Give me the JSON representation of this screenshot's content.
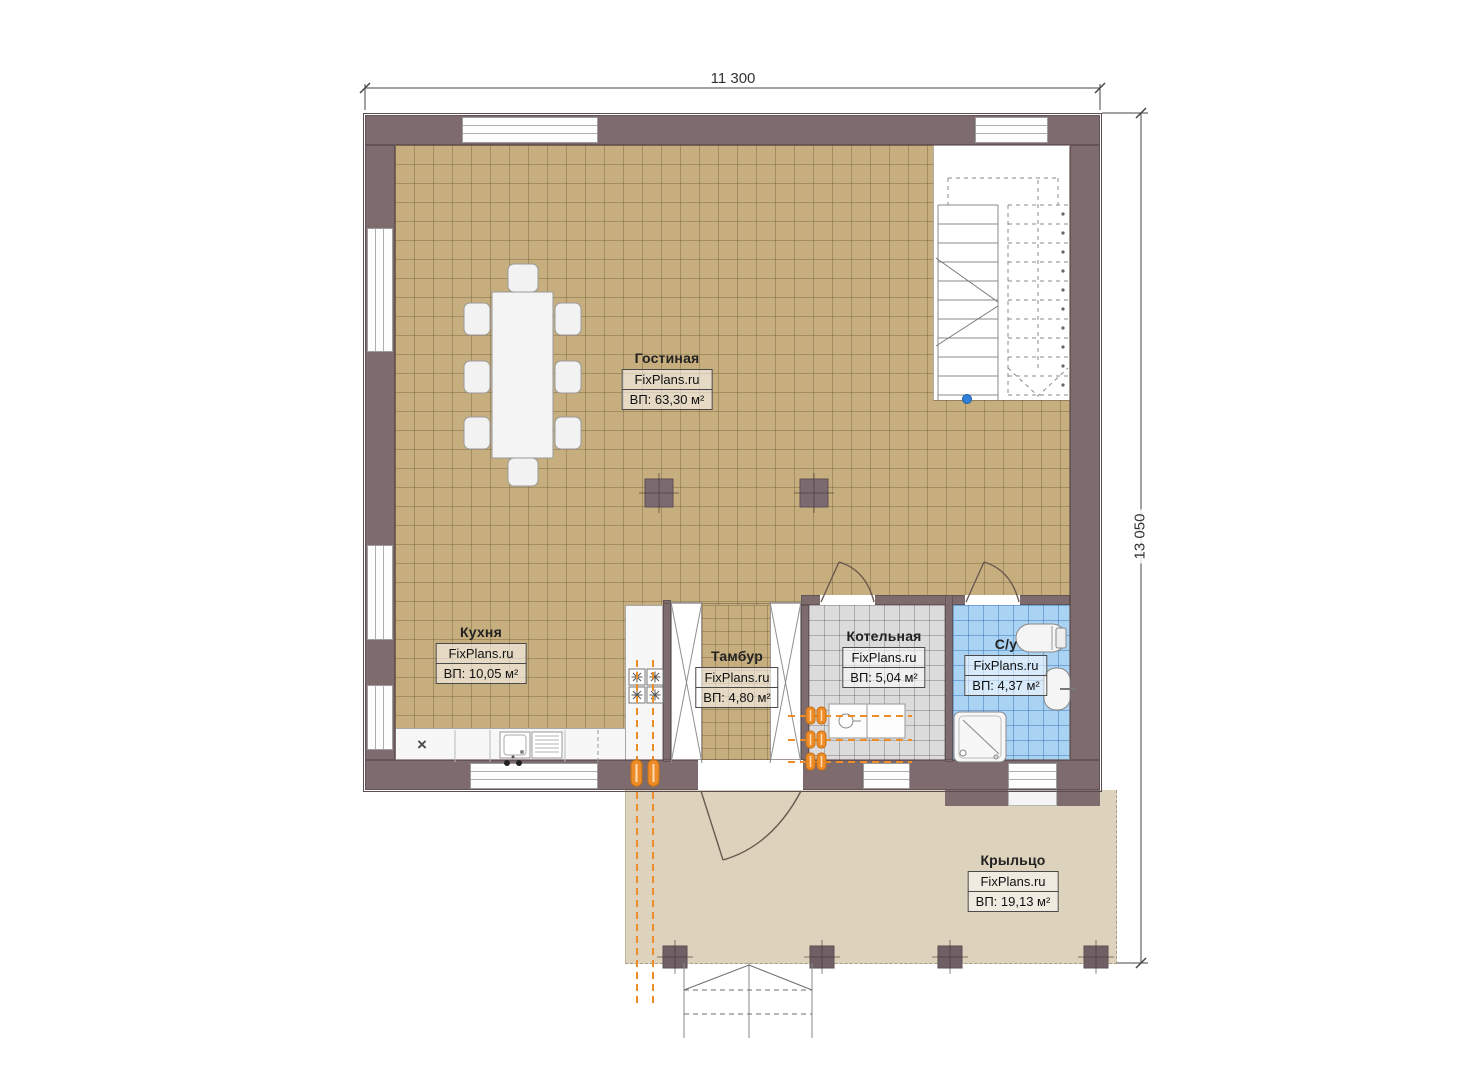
{
  "dimensions": {
    "width_label": "11 300",
    "height_label": "13 050"
  },
  "watermark": "FixPlans.ru",
  "rooms": [
    {
      "name": "Гостиная",
      "area": "ВП: 63,30 м²"
    },
    {
      "name": "Кухня",
      "area": "ВП: 10,05 м²"
    },
    {
      "name": "Тамбур",
      "area": "ВП: 4,80 м²"
    },
    {
      "name": "Котельная",
      "area": "ВП: 5,04 м²"
    },
    {
      "name": "С/у",
      "area": "ВП: 4,37 м²"
    },
    {
      "name": "Крыльцо",
      "area": "ВП: 19,13 м²"
    }
  ],
  "markers": {
    "appliance": "×"
  },
  "colors": {
    "wall": "#7d6b6d",
    "floor_tan": "#c7ae7e",
    "floor_gray": "#dbdbdb",
    "floor_blue": "#aad2f3",
    "porch": "#ddd2bc",
    "pipes_orange": "#ef8c2a",
    "stair_dot_blue": "#2f80d6"
  }
}
